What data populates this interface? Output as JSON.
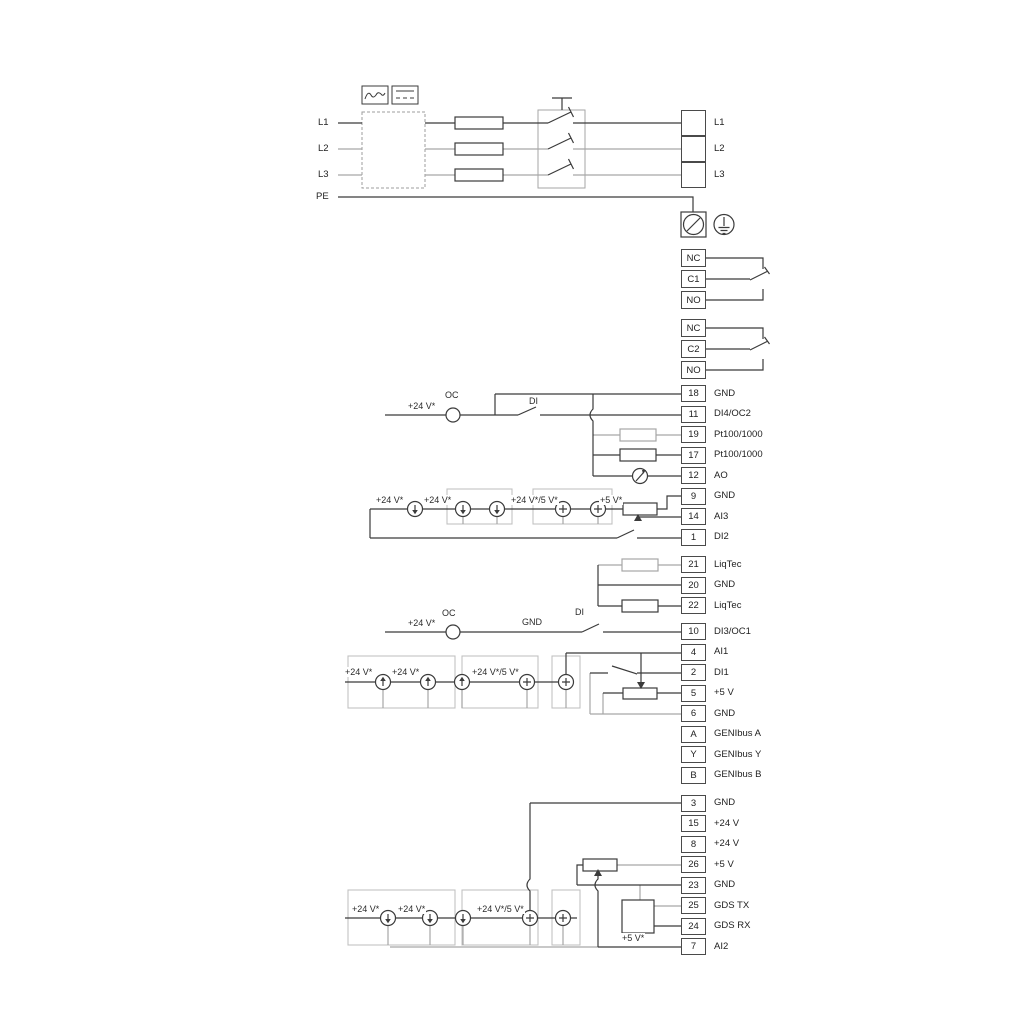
{
  "power": {
    "input_labels": [
      {
        "text": "L1",
        "x": 318,
        "y": 117
      },
      {
        "text": "L2",
        "x": 318,
        "y": 143
      },
      {
        "text": "L3",
        "x": 318,
        "y": 169
      },
      {
        "text": "PE",
        "x": 316,
        "y": 191
      }
    ]
  },
  "blocks": [
    {
      "name": "mains-terminals",
      "x": 681,
      "top": 110,
      "pitch": 26,
      "cellH": 26,
      "rows": [
        {
          "id": "",
          "label": "L1"
        },
        {
          "id": "",
          "label": "L2"
        },
        {
          "id": "",
          "label": "L3"
        }
      ]
    },
    {
      "name": "relay-1",
      "x": 681,
      "top": 249,
      "pitch": 21,
      "cellH": 18,
      "rows": [
        {
          "id": "NC",
          "label": ""
        },
        {
          "id": "C1",
          "label": ""
        },
        {
          "id": "NO",
          "label": ""
        }
      ]
    },
    {
      "name": "relay-2",
      "x": 681,
      "top": 319,
      "pitch": 21,
      "cellH": 18,
      "rows": [
        {
          "id": "NC",
          "label": ""
        },
        {
          "id": "C2",
          "label": ""
        },
        {
          "id": "NO",
          "label": ""
        }
      ]
    },
    {
      "name": "io-terminals-1",
      "x": 681,
      "top": 385,
      "pitch": 20.5,
      "cellH": 17,
      "rows": [
        {
          "id": "18",
          "label": "GND"
        },
        {
          "id": "11",
          "label": "DI4/OC2"
        },
        {
          "id": "19",
          "label": "Pt100/1000"
        },
        {
          "id": "17",
          "label": "Pt100/1000"
        },
        {
          "id": "12",
          "label": "AO"
        },
        {
          "id": "9",
          "label": "GND"
        },
        {
          "id": "14",
          "label": "AI3"
        },
        {
          "id": "1",
          "label": "DI2"
        }
      ]
    },
    {
      "name": "liqtec-terminals",
      "x": 681,
      "top": 556,
      "pitch": 20.5,
      "cellH": 17,
      "rows": [
        {
          "id": "21",
          "label": "LiqTec"
        },
        {
          "id": "20",
          "label": "GND"
        },
        {
          "id": "22",
          "label": "LiqTec"
        }
      ]
    },
    {
      "name": "io-terminals-2",
      "x": 681,
      "top": 623,
      "pitch": 20.5,
      "cellH": 17,
      "rows": [
        {
          "id": "10",
          "label": "DI3/OC1"
        },
        {
          "id": "4",
          "label": "AI1"
        },
        {
          "id": "2",
          "label": "DI1"
        },
        {
          "id": "5",
          "label": "+5 V"
        },
        {
          "id": "6",
          "label": "GND"
        },
        {
          "id": "A",
          "label": "GENIbus A"
        },
        {
          "id": "Y",
          "label": "GENIbus Y"
        },
        {
          "id": "B",
          "label": "GENIbus B"
        }
      ]
    },
    {
      "name": "io-terminals-3",
      "x": 681,
      "top": 794.5,
      "pitch": 20.5,
      "cellH": 17,
      "rows": [
        {
          "id": "3",
          "label": "GND"
        },
        {
          "id": "15",
          "label": "+24 V"
        },
        {
          "id": "8",
          "label": "+24 V"
        },
        {
          "id": "26",
          "label": "+5 V"
        },
        {
          "id": "23",
          "label": "GND"
        },
        {
          "id": "25",
          "label": "GDS TX"
        },
        {
          "id": "24",
          "label": "GDS RX"
        },
        {
          "id": "7",
          "label": "AI2"
        }
      ]
    }
  ],
  "annotations": [
    {
      "text": "+24 V*",
      "x": 407,
      "y": 401
    },
    {
      "text": "OC",
      "x": 444,
      "y": 390
    },
    {
      "text": "DI",
      "x": 528,
      "y": 396
    },
    {
      "text": "+24 V*",
      "x": 375,
      "y": 495
    },
    {
      "text": "+24 V*",
      "x": 423,
      "y": 495
    },
    {
      "text": "+24 V*/5 V*",
      "x": 510,
      "y": 495
    },
    {
      "text": "+5 V*",
      "x": 599,
      "y": 495
    },
    {
      "text": "+24 V*",
      "x": 407,
      "y": 618
    },
    {
      "text": "OC",
      "x": 441,
      "y": 608
    },
    {
      "text": "GND",
      "x": 521,
      "y": 617
    },
    {
      "text": "DI",
      "x": 574,
      "y": 607
    },
    {
      "text": "+24 V*",
      "x": 344,
      "y": 667
    },
    {
      "text": "+24 V*",
      "x": 391,
      "y": 667
    },
    {
      "text": "+24 V*/5 V*",
      "x": 471,
      "y": 667
    },
    {
      "text": "+24 V*",
      "x": 351,
      "y": 904
    },
    {
      "text": "+24 V*",
      "x": 397,
      "y": 904
    },
    {
      "text": "+24 V*/5 V*",
      "x": 476,
      "y": 904
    },
    {
      "text": "+5 V*",
      "x": 621,
      "y": 933
    }
  ]
}
